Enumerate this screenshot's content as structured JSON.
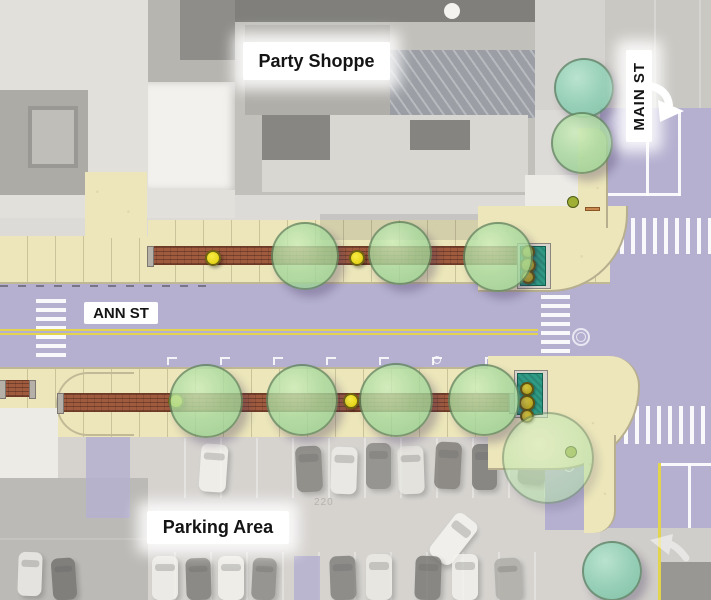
{
  "canvas": {
    "width": 711,
    "height": 600
  },
  "labels": {
    "party_shoppe": {
      "text": "Party Shoppe"
    },
    "main_st": {
      "text": "MAIN ST"
    },
    "ann_st": {
      "text": "ANN ST"
    },
    "parking_area": {
      "text": "Parking Area"
    }
  },
  "aerial": {
    "parking_lot_number": "220"
  },
  "colors": {
    "street_purple": "#b5b0d0",
    "sidewalk_tan": "#ece6ba",
    "brick_red": "#a05a3e",
    "tree_green": "#a9da9f",
    "tree_teal": "#8ad0b4",
    "planter_teal": "#2f9b85",
    "light_yellow": "#f0e01c",
    "bollard_olive": "#c3b32a",
    "center_line_yellow": "#e3d44e",
    "marking_white": "#ffffff"
  },
  "features": {
    "trees": [
      {
        "x": 305,
        "y": 256,
        "r": 34,
        "v": "green"
      },
      {
        "x": 400,
        "y": 253,
        "r": 32,
        "v": "green"
      },
      {
        "x": 498,
        "y": 257,
        "r": 35,
        "v": "green"
      },
      {
        "x": 584,
        "y": 88,
        "r": 30,
        "v": "teal"
      },
      {
        "x": 582,
        "y": 143,
        "r": 31,
        "v": "green"
      },
      {
        "x": 206,
        "y": 401,
        "r": 37,
        "v": "green"
      },
      {
        "x": 302,
        "y": 400,
        "r": 36,
        "v": "green"
      },
      {
        "x": 396,
        "y": 400,
        "r": 37,
        "v": "green"
      },
      {
        "x": 484,
        "y": 400,
        "r": 36,
        "v": "green"
      },
      {
        "x": 548,
        "y": 458,
        "r": 46,
        "v": "pale"
      },
      {
        "x": 612,
        "y": 571,
        "r": 30,
        "v": "teal"
      }
    ],
    "street_lights": [
      {
        "x": 213,
        "y": 258
      },
      {
        "x": 357,
        "y": 258
      },
      {
        "x": 176,
        "y": 401
      },
      {
        "x": 351,
        "y": 401
      }
    ],
    "planters": [
      {
        "x": 517,
        "y": 243,
        "w": 34,
        "h": 46
      },
      {
        "x": 514,
        "y": 370,
        "w": 34,
        "h": 48
      }
    ],
    "planter_bollards": [
      {
        "x": 528,
        "y": 252,
        "r": 7
      },
      {
        "x": 528,
        "y": 265,
        "r": 8
      },
      {
        "x": 528,
        "y": 277,
        "r": 7
      },
      {
        "x": 527,
        "y": 389,
        "r": 7
      },
      {
        "x": 527,
        "y": 403,
        "r": 8
      },
      {
        "x": 527,
        "y": 416,
        "r": 7
      }
    ],
    "crosswalks": [
      {
        "x": 36,
        "y": 299,
        "bw": 30,
        "bh": 4,
        "n": 7,
        "dx": 0,
        "dy": 9
      },
      {
        "x": 541,
        "y": 295,
        "bw": 29,
        "bh": 4,
        "n": 7,
        "dx": 0,
        "dy": 9
      },
      {
        "x": 620,
        "y": 218,
        "bw": 4,
        "bh": 36,
        "n": 9,
        "dx": 11,
        "dy": 0
      },
      {
        "x": 624,
        "y": 406,
        "bw": 4,
        "bh": 38,
        "n": 8,
        "dx": 11,
        "dy": 0
      }
    ],
    "lane_lines": [
      {
        "x": 646,
        "y": 112,
        "w": 3,
        "h": 84,
        "c": "white"
      },
      {
        "x": 678,
        "y": 112,
        "w": 3,
        "h": 84,
        "c": "white"
      },
      {
        "x": 592,
        "y": 193,
        "w": 88,
        "h": 3,
        "c": "white"
      },
      {
        "x": 688,
        "y": 464,
        "w": 3,
        "h": 64,
        "c": "white"
      },
      {
        "x": 658,
        "y": 463,
        "w": 53,
        "h": 3,
        "c": "white"
      },
      {
        "x": 658,
        "y": 463,
        "w": 3,
        "h": 137,
        "c": "yellow"
      }
    ],
    "center_lines": [
      {
        "x": 0,
        "y": 329,
        "w": 538,
        "h": 2
      },
      {
        "x": 0,
        "y": 333,
        "w": 538,
        "h": 2
      }
    ],
    "stall_ticks": {
      "y": 357,
      "xs": [
        167,
        220,
        273,
        326,
        379,
        432,
        485
      ]
    },
    "misc": [
      {
        "type": "manhole",
        "x": 581,
        "y": 337,
        "r": 9
      },
      {
        "type": "dot",
        "x": 573,
        "y": 202,
        "r": 6,
        "c": "#9fae35"
      },
      {
        "type": "dot",
        "x": 571,
        "y": 452,
        "r": 6,
        "c": "#9fae35"
      },
      {
        "type": "ring",
        "x": 569,
        "y": 467,
        "r": 5
      },
      {
        "type": "ring",
        "x": 437,
        "y": 360,
        "r": 4
      },
      {
        "type": "bench",
        "x": 585,
        "y": 207,
        "w": 15,
        "h": 4
      }
    ],
    "cars": [
      {
        "x": 200,
        "y": 444,
        "w": 27,
        "h": 48,
        "rot": 4,
        "c": "#f1efe9"
      },
      {
        "x": 296,
        "y": 446,
        "w": 26,
        "h": 46,
        "rot": -3,
        "c": "#4b4843"
      },
      {
        "x": 331,
        "y": 447,
        "w": 26,
        "h": 47,
        "rot": 2,
        "c": "#e9e7e1"
      },
      {
        "x": 366,
        "y": 443,
        "w": 25,
        "h": 46,
        "rot": 0,
        "c": "#56534d"
      },
      {
        "x": 398,
        "y": 446,
        "w": 26,
        "h": 48,
        "rot": -2,
        "c": "#dedcd5"
      },
      {
        "x": 435,
        "y": 442,
        "w": 26,
        "h": 47,
        "rot": 3,
        "c": "#454039"
      },
      {
        "x": 472,
        "y": 444,
        "w": 25,
        "h": 46,
        "rot": 0,
        "c": "#3a3833"
      },
      {
        "x": 519,
        "y": 440,
        "w": 28,
        "h": 45,
        "rot": 6,
        "c": "#6b6862"
      },
      {
        "x": 440,
        "y": 513,
        "w": 27,
        "h": 52,
        "rot": 38,
        "c": "#f4f2ec"
      },
      {
        "x": 152,
        "y": 556,
        "w": 26,
        "h": 44,
        "rot": 0,
        "c": "#eceae4"
      },
      {
        "x": 186,
        "y": 558,
        "w": 25,
        "h": 42,
        "rot": -2,
        "c": "#413e39"
      },
      {
        "x": 218,
        "y": 556,
        "w": 26,
        "h": 44,
        "rot": 0,
        "c": "#f0eee8"
      },
      {
        "x": 252,
        "y": 558,
        "w": 24,
        "h": 42,
        "rot": 3,
        "c": "#56534d"
      },
      {
        "x": 330,
        "y": 556,
        "w": 26,
        "h": 44,
        "rot": -2,
        "c": "#47443f"
      },
      {
        "x": 366,
        "y": 554,
        "w": 26,
        "h": 46,
        "rot": 0,
        "c": "#e5e3dc"
      },
      {
        "x": 415,
        "y": 556,
        "w": 26,
        "h": 44,
        "rot": 2,
        "c": "#3d3a35"
      },
      {
        "x": 452,
        "y": 554,
        "w": 26,
        "h": 46,
        "rot": 0,
        "c": "#efede7"
      },
      {
        "x": 495,
        "y": 558,
        "w": 26,
        "h": 42,
        "rot": -3,
        "c": "#8a8780"
      },
      {
        "x": 18,
        "y": 552,
        "w": 24,
        "h": 44,
        "rot": 2,
        "c": "#e8e6e0"
      },
      {
        "x": 52,
        "y": 558,
        "w": 24,
        "h": 42,
        "rot": -4,
        "c": "#35332f"
      }
    ]
  }
}
